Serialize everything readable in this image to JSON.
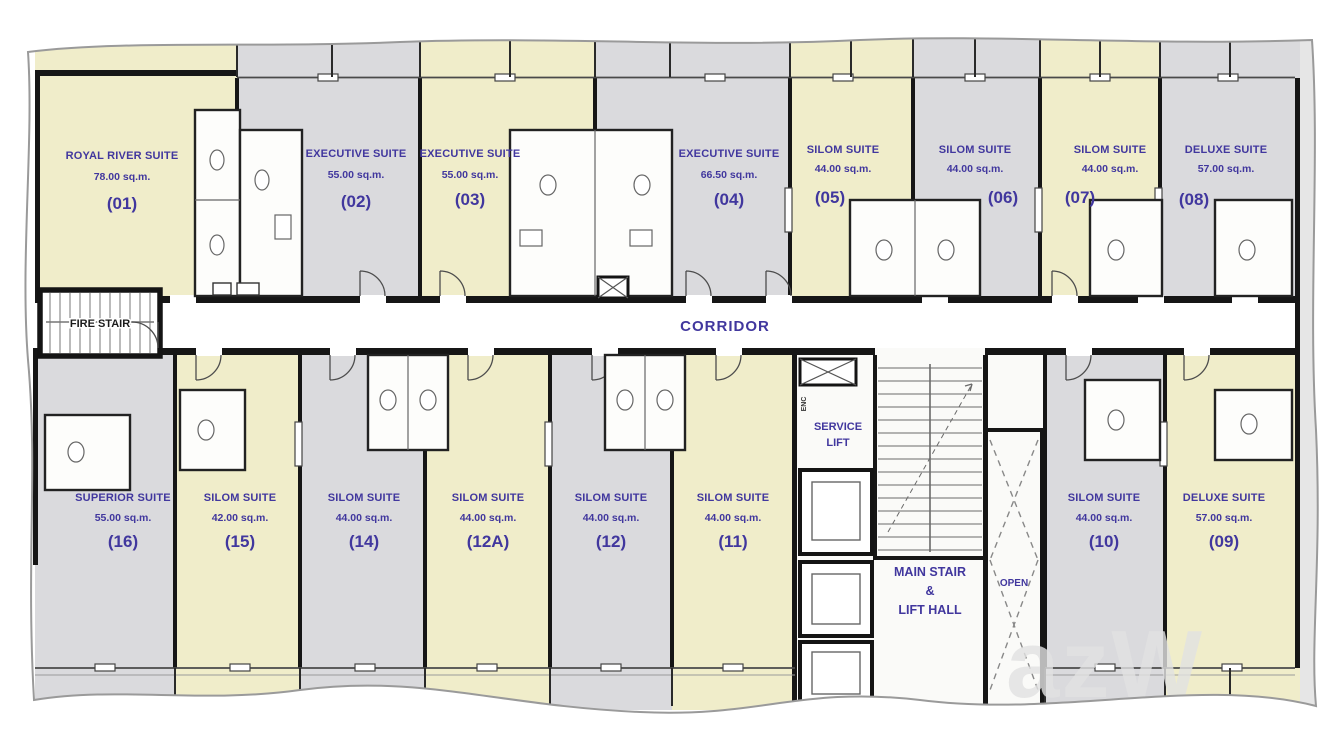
{
  "plan_type": "residential-floor-plan",
  "colors": {
    "room_yellow": "#f0edca",
    "room_gray": "#dadadd",
    "corridor_white": "#ffffff",
    "wall_black": "#161616",
    "label_purple": "#41379e",
    "line_gray": "#6a6a6a",
    "watermark_gray": "#e2e2e2"
  },
  "corridor": {
    "label": "CORRIDOR"
  },
  "fire_stair": {
    "label": "FIRE STAIR"
  },
  "core": {
    "service_lift": {
      "line1": "SERVICE",
      "line2": "LIFT"
    },
    "main_stair": {
      "line1": "MAIN STAIR",
      "line2": "&",
      "line3": "LIFT HALL"
    },
    "open_shaft": {
      "label": "OPEN"
    },
    "enc": {
      "label": "ENC"
    }
  },
  "watermark": {
    "text": "azW"
  },
  "rooms": {
    "r01": {
      "name": "ROYAL RIVER SUITE",
      "area": "78.00 sq.m.",
      "number": "(01)",
      "tone": "yellow"
    },
    "r02": {
      "name": "EXECUTIVE SUITE",
      "area": "55.00 sq.m.",
      "number": "(02)",
      "tone": "gray"
    },
    "r03": {
      "name": "EXECUTIVE SUITE",
      "area": "55.00 sq.m.",
      "number": "(03)",
      "tone": "yellow"
    },
    "r04": {
      "name": "EXECUTIVE SUITE",
      "area": "66.50 sq.m.",
      "number": "(04)",
      "tone": "gray"
    },
    "r05": {
      "name": "SILOM SUITE",
      "area": "44.00 sq.m.",
      "number": "(05)",
      "tone": "yellow"
    },
    "r06": {
      "name": "SILOM SUITE",
      "area": "44.00 sq.m.",
      "number": "(06)",
      "tone": "gray"
    },
    "r07": {
      "name": "SILOM SUITE",
      "area": "44.00 sq.m.",
      "number": "(07)",
      "tone": "yellow"
    },
    "r08": {
      "name": "DELUXE SUITE",
      "area": "57.00 sq.m.",
      "number": "(08)",
      "tone": "gray"
    },
    "r16": {
      "name": "SUPERIOR SUITE",
      "area": "55.00 sq.m.",
      "number": "(16)",
      "tone": "gray"
    },
    "r15": {
      "name": "SILOM SUITE",
      "area": "42.00 sq.m.",
      "number": "(15)",
      "tone": "yellow"
    },
    "r14": {
      "name": "SILOM SUITE",
      "area": "44.00 sq.m.",
      "number": "(14)",
      "tone": "gray"
    },
    "r12A": {
      "name": "SILOM SUITE",
      "area": "44.00 sq.m.",
      "number": "(12A)",
      "tone": "yellow"
    },
    "r12": {
      "name": "SILOM SUITE",
      "area": "44.00 sq.m.",
      "number": "(12)",
      "tone": "gray"
    },
    "r11": {
      "name": "SILOM SUITE",
      "area": "44.00 sq.m.",
      "number": "(11)",
      "tone": "yellow"
    },
    "r10": {
      "name": "SILOM SUITE",
      "area": "44.00 sq.m.",
      "number": "(10)",
      "tone": "gray"
    },
    "r09": {
      "name": "DELUXE SUITE",
      "area": "57.00 sq.m.",
      "number": "(09)",
      "tone": "yellow"
    }
  }
}
